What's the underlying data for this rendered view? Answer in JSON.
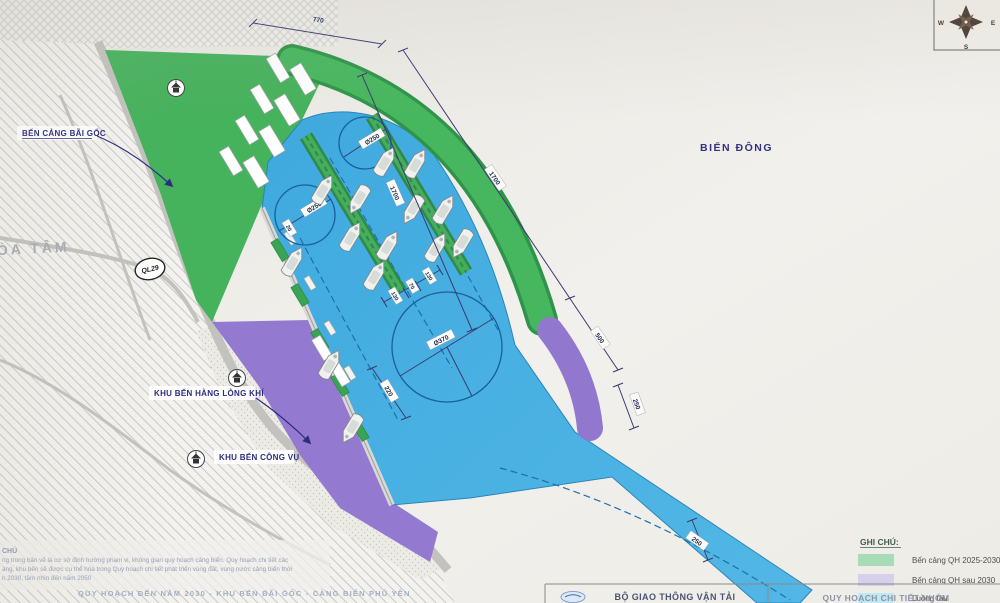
{
  "map": {
    "sea_label": "BIỂN ĐÔNG",
    "district_label": "HÒA TÂM",
    "callouts": {
      "bai_goc": "BẾN CẢNG BÃI GỐC",
      "hang_long_khi": "KHU BẾN HÀNG LỎNG KHÍ",
      "cong_vu": "KHU BẾN CÔNG VỤ"
    },
    "road_badge": "QL29",
    "compass": {
      "w": "W",
      "s": "S",
      "e": "E"
    },
    "dimensions": {
      "d770": "770",
      "d1700": "1700",
      "d500": "500",
      "d250_ext": "250",
      "d250_channel": "250",
      "d220": "220",
      "d20": "20",
      "gap": [
        "130",
        "70",
        "130"
      ],
      "circle_large": "Ø370",
      "circle_small": "Ø250"
    }
  },
  "legend": {
    "title": "GHI CHÚ:",
    "items": [
      {
        "color": "#a8dcb9",
        "label": "Bến cảng QH 2025-2030"
      },
      {
        "color": "#d7d0ed",
        "label": "Bến cảng QH sau 2030"
      },
      {
        "color": "#bfe8f1",
        "label": "Luồng tàu"
      }
    ]
  },
  "notes": {
    "heading": "CHÚ",
    "line1": "ng trong bản vẽ là cơ sở định hướng phạm vi, không gian quy hoạch cảng biển. Quy hoạch chi tiết các",
    "line2": "àng, khu bến sẽ được cụ thể hóa trong Quy hoạch chi tiết phát triển vùng đất, vùng nước cảng biển thời",
    "line3": "n 2030, tầm nhìn đến năm 2050"
  },
  "footer": {
    "drawing_title": "QUY HOẠCH ĐẾN NĂM 2030 - KHU BẾN BÃI GỐC - CẢNG BIỂN PHÚ YÊN",
    "agency": "BỘ GIAO THÔNG VẬN TẢI",
    "project": "QUY HOẠCH CHI TIẾT NHÓM"
  },
  "colors": {
    "berth_qh_2025_2030": "#45b25c",
    "berth_qh_after_2030": "#9379cf",
    "channel_water": "#41ace0",
    "sea_text": "#32327e"
  }
}
